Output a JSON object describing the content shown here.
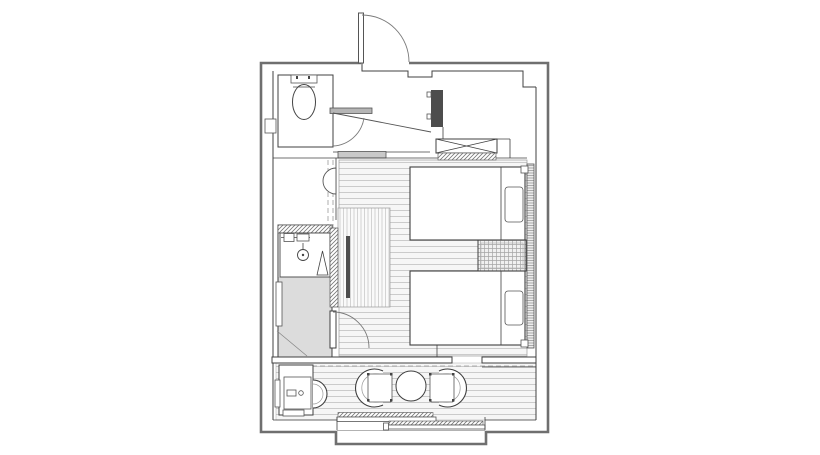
{
  "document": {
    "kind": "architectural-floor-plan",
    "subject": "hotel twin room plan with entrance, toilet, shower room, closet, twin beds and window-side sitting area",
    "canvas": {
      "width": 820,
      "height": 455
    },
    "visible_text": []
  },
  "palette": {
    "background": "#ffffff",
    "wall-outer": "#6f6f6f",
    "wall-inner": "#404040",
    "door-arc": "#7a7a7a",
    "dash-line": "#999999",
    "floor-bg": "#f6f6f6",
    "floor-line": "#cbcbcb",
    "stripe-line": "#cfcfcf",
    "dark-fill": "#4d4d4d",
    "gray-area": "#dcdcdc",
    "hatch-line": "#777777",
    "band-fill": "#c9c9c9"
  },
  "fixtures": [
    {
      "name": "entrance-door",
      "type": "swing-door"
    },
    {
      "name": "toilet",
      "type": "wc-with-tank"
    },
    {
      "name": "toilet-paper-holder",
      "type": "wall-box"
    },
    {
      "name": "hall-door",
      "type": "swing-door-open"
    },
    {
      "name": "structural-pillar",
      "type": "solid-column"
    },
    {
      "name": "luggage-rack",
      "type": "crossed-rectangle"
    },
    {
      "name": "closet-shelf",
      "type": "hatched-strip"
    },
    {
      "name": "wash-basin",
      "type": "half-round-basin"
    },
    {
      "name": "shower-stall",
      "type": "shower-with-mixer-and-drain"
    },
    {
      "name": "glass-partition",
      "type": "dark-panel"
    },
    {
      "name": "changing-area",
      "type": "gray-zone"
    },
    {
      "name": "towel-rail",
      "type": "wall-rail"
    },
    {
      "name": "bed-1",
      "type": "single-bed-with-pillow"
    },
    {
      "name": "bed-2",
      "type": "single-bed-with-pillow"
    },
    {
      "name": "nightstand",
      "type": "plaid-table"
    },
    {
      "name": "headboard-panel",
      "type": "lined-strip"
    },
    {
      "name": "vanity-sink",
      "type": "counter-basin"
    },
    {
      "name": "stool",
      "type": "half-round-stool"
    },
    {
      "name": "armchair-left",
      "type": "tub-chair"
    },
    {
      "name": "armchair-right",
      "type": "tub-chair"
    },
    {
      "name": "round-table",
      "type": "circle-table"
    },
    {
      "name": "sliding-window",
      "type": "double-sliding-sash"
    },
    {
      "name": "curtain-rail",
      "type": "dashed-track"
    }
  ]
}
